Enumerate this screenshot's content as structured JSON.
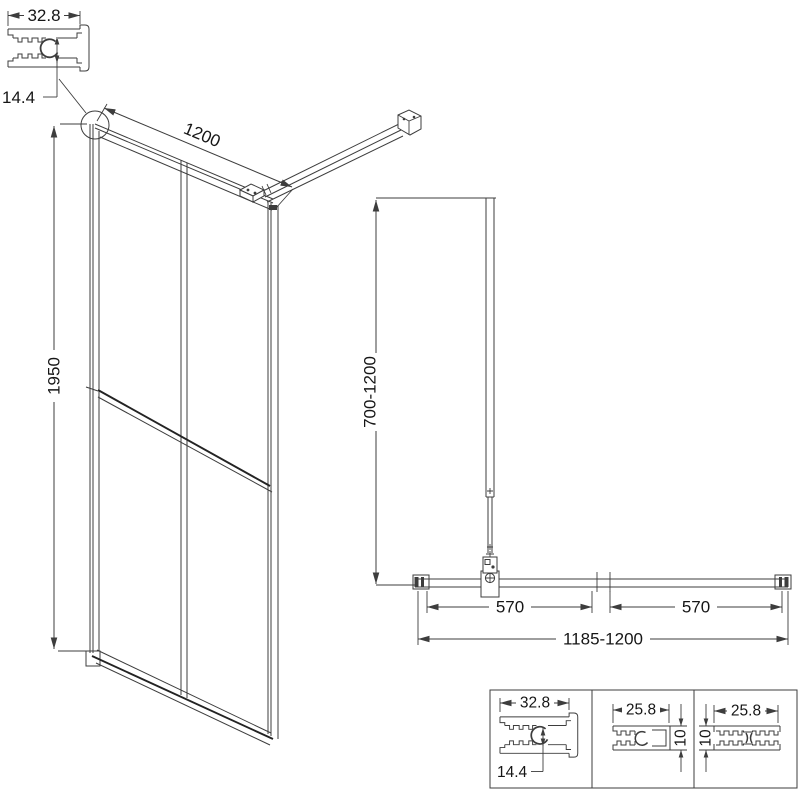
{
  "title": "Walk-in shower screen technical drawing",
  "colors": {
    "line": "#3d3d3d",
    "background": "#ffffff",
    "text": "#161616"
  },
  "labels": {
    "profile_top": {
      "width": "32.8",
      "height": "14.4"
    },
    "front": {
      "width": "1200",
      "height": "1950"
    },
    "plan": {
      "bar": "700-1200",
      "left": "570",
      "right": "570",
      "overall": "1185-1200"
    },
    "details": {
      "cell1": {
        "width": "32.8",
        "height": "14.4"
      },
      "cell2": {
        "width": "25.8",
        "height": "10"
      },
      "cell3": {
        "width": "25.8",
        "height": "10"
      }
    }
  }
}
